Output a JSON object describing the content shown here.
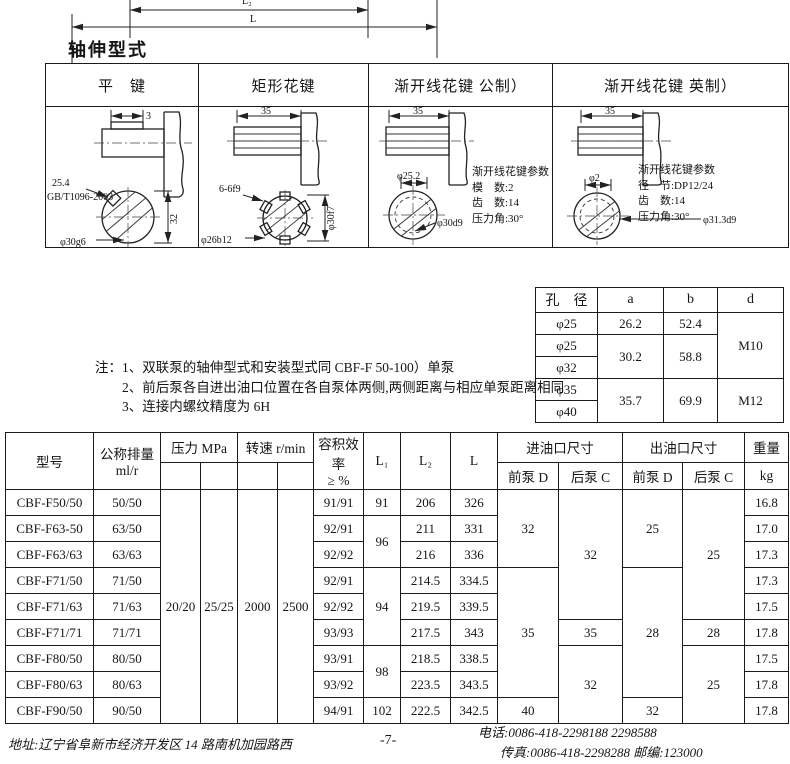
{
  "page": {
    "section_title": "轴伸型式",
    "page_number": "-7-"
  },
  "top_drawing": {
    "dim_l2": "L₂",
    "dim_l": "L"
  },
  "spline_table": {
    "headers": [
      "平　键",
      "矩形花键",
      "渐开线花键 公制）",
      "渐开线花键 英制）"
    ],
    "flat_key": {
      "dim_top": "3",
      "dim_len": "25.4",
      "std": "GB/T1096-2003",
      "dim_vert": "32",
      "dim_bottom": "φ30g6"
    },
    "rect_spline": {
      "dim_top": "35",
      "dim_key": "6-6f9",
      "dim_vert": "φ30f7",
      "dim_bottom": "φ26b12"
    },
    "involute_metric": {
      "dim_top": "35",
      "dim_dia": "φ25.2",
      "dim_dia2": "φ30d9",
      "params": [
        "渐开线花键参数",
        "模　数:2",
        "齿　数:14",
        "压力角:30°"
      ]
    },
    "involute_inch": {
      "dim_top": "35",
      "dim_dia": "φ2",
      "dim_dia2": "φ31.3d9",
      "params": [
        "渐开线花键参数",
        "径　节:DP12/24",
        "齿　数:14",
        "压力角:30°"
      ]
    }
  },
  "bore_table": {
    "headers": [
      "孔　径",
      "a",
      "b",
      "d"
    ],
    "rows": [
      [
        "φ25",
        "26.2",
        "52.4",
        "M10"
      ],
      [
        "φ25",
        "30.2",
        "58.8"
      ],
      [
        "φ32"
      ],
      [
        "φ35",
        "35.7",
        "69.9",
        "M12"
      ],
      [
        "φ40"
      ]
    ]
  },
  "notes": {
    "lines": [
      "注：1、双联泵的轴伸型式和安装型式同 CBF-F 50-100）单泵",
      "2、前后泵各自进出油口位置在各自泵体两侧,两侧距离与相应单泵距离相同",
      "3、连接内螺纹精度为 6H"
    ]
  },
  "spec_table": {
    "headers": {
      "model": "型号",
      "displacement": "公称排量",
      "displacement_unit": "ml/r",
      "pressure": "压力 MPa",
      "speed": "转速 r/min",
      "efficiency": "容积效率",
      "efficiency_unit": "≥ %",
      "l1": "L₁",
      "l2": "L₂",
      "l": "L",
      "inlet": "进油口尺寸",
      "outlet": "出油口尺寸",
      "front_d": "前泵 D",
      "rear_c": "后泵 C",
      "weight": "重量",
      "weight_unit": "kg"
    },
    "shared": {
      "p1": "20/20",
      "p2": "25/25",
      "n1": "2000",
      "n2": "2500"
    },
    "rows": [
      {
        "model": "CBF-F50/50",
        "disp": "50/50",
        "eff": "91/91",
        "l1": "91",
        "l2": "206",
        "l": "326",
        "in_d": "32",
        "in_c": "32",
        "out_d": "25",
        "out_c": "25",
        "wt": "16.8"
      },
      {
        "model": "CBF-F63-50",
        "disp": "63/50",
        "eff": "92/91",
        "l1": "96",
        "l2": "211",
        "l": "331",
        "wt": "17.0"
      },
      {
        "model": "CBF-F63/63",
        "disp": "63/63",
        "eff": "92/92",
        "l2": "216",
        "l": "336",
        "wt": "17.3"
      },
      {
        "model": "CBF-F71/50",
        "disp": "71/50",
        "eff": "92/91",
        "l1": "94",
        "l2": "214.5",
        "l": "334.5",
        "in_d": "35",
        "out_d": "28",
        "wt": "17.3"
      },
      {
        "model": "CBF-F71/63",
        "disp": "71/63",
        "eff": "92/92",
        "l2": "219.5",
        "l": "339.5",
        "wt": "17.5"
      },
      {
        "model": "CBF-F71/71",
        "disp": "71/71",
        "eff": "93/93",
        "l2": "217.5",
        "l": "343",
        "in_c": "35",
        "out_c": "28",
        "wt": "17.8"
      },
      {
        "model": "CBF-F80/50",
        "disp": "80/50",
        "eff": "93/91",
        "l1": "98",
        "l2": "218.5",
        "l": "338.5",
        "in_c": "32",
        "out_c": "25",
        "wt": "17.5"
      },
      {
        "model": "CBF-F80/63",
        "disp": "80/63",
        "eff": "93/92",
        "l2": "223.5",
        "l": "343.5",
        "wt": "17.8"
      },
      {
        "model": "CBF-F90/50",
        "disp": "90/50",
        "eff": "94/91",
        "l1": "102",
        "l2": "222.5",
        "l": "342.5",
        "in_d": "40",
        "out_d": "32",
        "wt": "17.8"
      }
    ]
  },
  "footer": {
    "address": "地址:辽宁省阜新市经济开发区 14 路南机加园路西",
    "phone": "电话:0086-418-2298188    2298588",
    "fax": "传真:0086-418-2298288    邮编:123000"
  }
}
